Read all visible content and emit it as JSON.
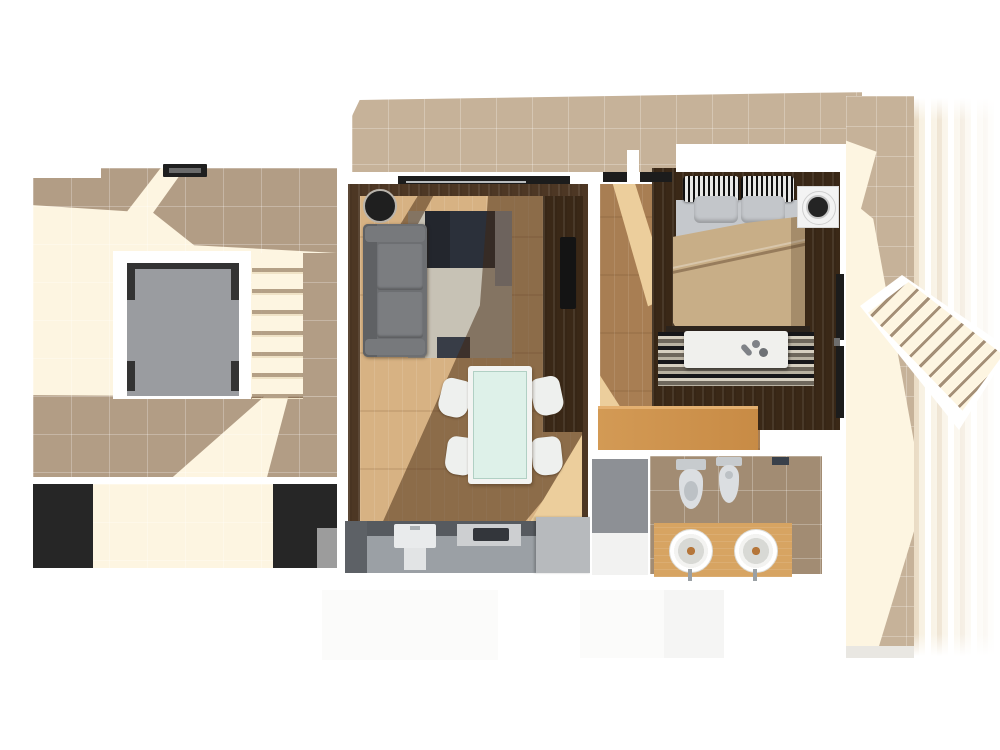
{
  "scene": {
    "kind": "apartment-floor-plan-3d-render",
    "areas": [
      {
        "name": "roof-terrace",
        "items": [
          "tiled-floor",
          "door-mat",
          "stairwell-opening",
          "corner-brackets",
          "terrace-staircase",
          "planter-left",
          "planter-right"
        ]
      },
      {
        "name": "balcony-strip",
        "items": [
          "tiled-floor"
        ]
      },
      {
        "name": "living-room",
        "items": [
          "sliding-door",
          "round-side-table",
          "sofa",
          "patchwork-rug",
          "tv-cabinet",
          "tv",
          "dining-table-glass-top",
          "dining-chair",
          "dining-chair",
          "dining-chair",
          "dining-chair",
          "kitchen-counter",
          "kitchen-sink",
          "cooktop"
        ]
      },
      {
        "name": "bedroom",
        "items": [
          "window",
          "window",
          "double-bed",
          "striped-pillow",
          "striped-pillow",
          "gray-pillow",
          "gray-pillow",
          "duvet",
          "striped-rug",
          "bench",
          "slippers",
          "washing-machine",
          "dresser",
          "side-window"
        ]
      },
      {
        "name": "bathroom",
        "items": [
          "shower",
          "toilet",
          "bidet",
          "vanity-counter",
          "round-sink",
          "round-sink"
        ]
      },
      {
        "name": "outdoor-walkway",
        "items": [
          "tiled-path",
          "diagonal-steps"
        ]
      }
    ],
    "lighting": "sunlight-from-upper-right-casting-diagonal-shadows"
  },
  "colors": {
    "tile_shade": "#b29d85",
    "tile_mid": "#c6b299",
    "tile_bright": "#fdf5e1",
    "grout": "rgba(255,255,255,0.26)",
    "brown_wall": "#4d3724",
    "brown_deep": "#3a2817",
    "wood_base": "#d7b283",
    "wood_lit": "#ecce9c",
    "bedwood_base": "#a87e53",
    "sofa_gray": "#6d6f72",
    "rug_light": "#c7c2b5",
    "rug_dark": "#2b303a",
    "glass_mint": "#def1e9",
    "furn_white": "#f3f4f2",
    "kitchen_dark": "#565a5f",
    "kitchen_mid": "#9ba0a5",
    "kitchen_light": "#b7babd",
    "pit_gray": "#9a9ca0",
    "planter_dark": "#262626",
    "duvet_tan": "#c8ae87",
    "sheet_gray": "#c5c8cc",
    "bath_tile": "#a28c73",
    "shower_gray": "#8d9095",
    "vanity_wood": "#d7a462",
    "dresser_wood": "#cf9250",
    "brass": "#b5763a",
    "window_dark": "#1c1c1c",
    "smear_a": "#eadcc5",
    "smear_b": "#f7f0e0",
    "shadow_brown": "rgba(66,38,16,0.5)"
  }
}
